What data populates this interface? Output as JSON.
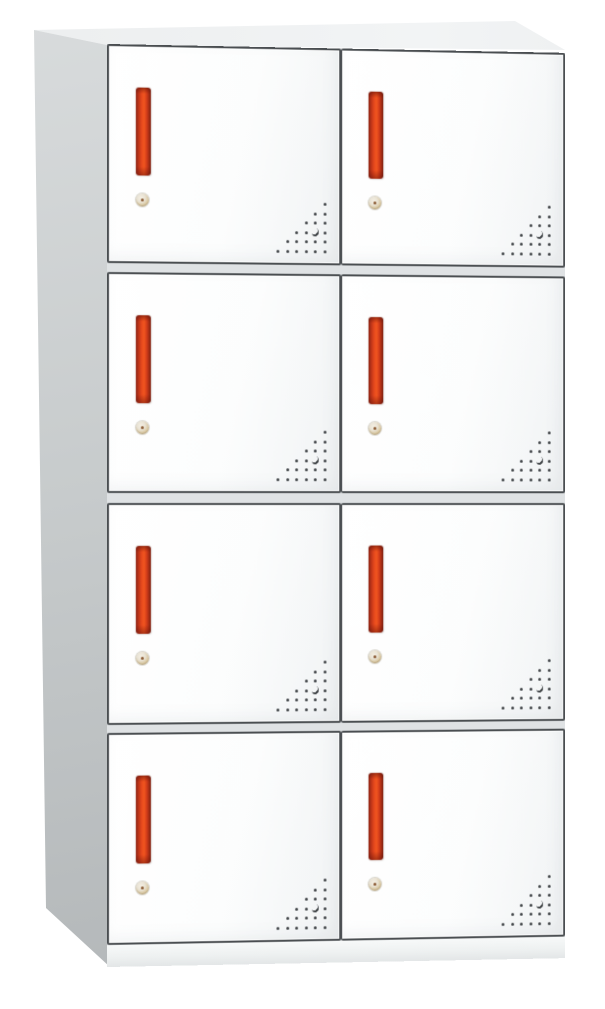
{
  "scene": {
    "type": "product-photograph",
    "subject": "white steel locker cabinet with eight doors",
    "view": "three-quarter perspective, left side panel visible",
    "background_color": "#ffffff"
  },
  "locker": {
    "rows": 4,
    "columns": 2,
    "door_count": 8,
    "doors": [
      {
        "row": 1,
        "col": 1
      },
      {
        "row": 1,
        "col": 2
      },
      {
        "row": 2,
        "col": 1
      },
      {
        "row": 2,
        "col": 2
      },
      {
        "row": 3,
        "col": 1
      },
      {
        "row": 3,
        "col": 2
      },
      {
        "row": 4,
        "col": 1
      },
      {
        "row": 4,
        "col": 2
      }
    ],
    "door_features": [
      "recessed-vertical-handle",
      "round-cam-lock",
      "ventilation-holes"
    ],
    "vent_pattern": {
      "rows": 6,
      "style": "right-triangle of round holes aligned to bottom-right corner of each door",
      "crescent_hole": {
        "row": 3,
        "col": 1
      }
    }
  },
  "colors": {
    "background": "#ffffff",
    "line_dark": "#4a4e51",
    "door_face": "#fcfdfd",
    "door_shade": "#eef0f1",
    "frame_gap": "#dfe2e4",
    "side_light": "#d9dcdd",
    "side_dark": "#afb3b5",
    "top_face": "#eceeef",
    "base_light": "#f7f9f9",
    "base_dark": "#e3e6e7",
    "handle_red": "#e84a1d",
    "handle_red_dark": "#8e2415",
    "handle_red_deep": "#7e1f10",
    "lock_ring": "#e9e3d5",
    "lock_face": "#d9c79f",
    "lock_pin": "#8a5a33",
    "vent_dot": "#3f4346"
  }
}
